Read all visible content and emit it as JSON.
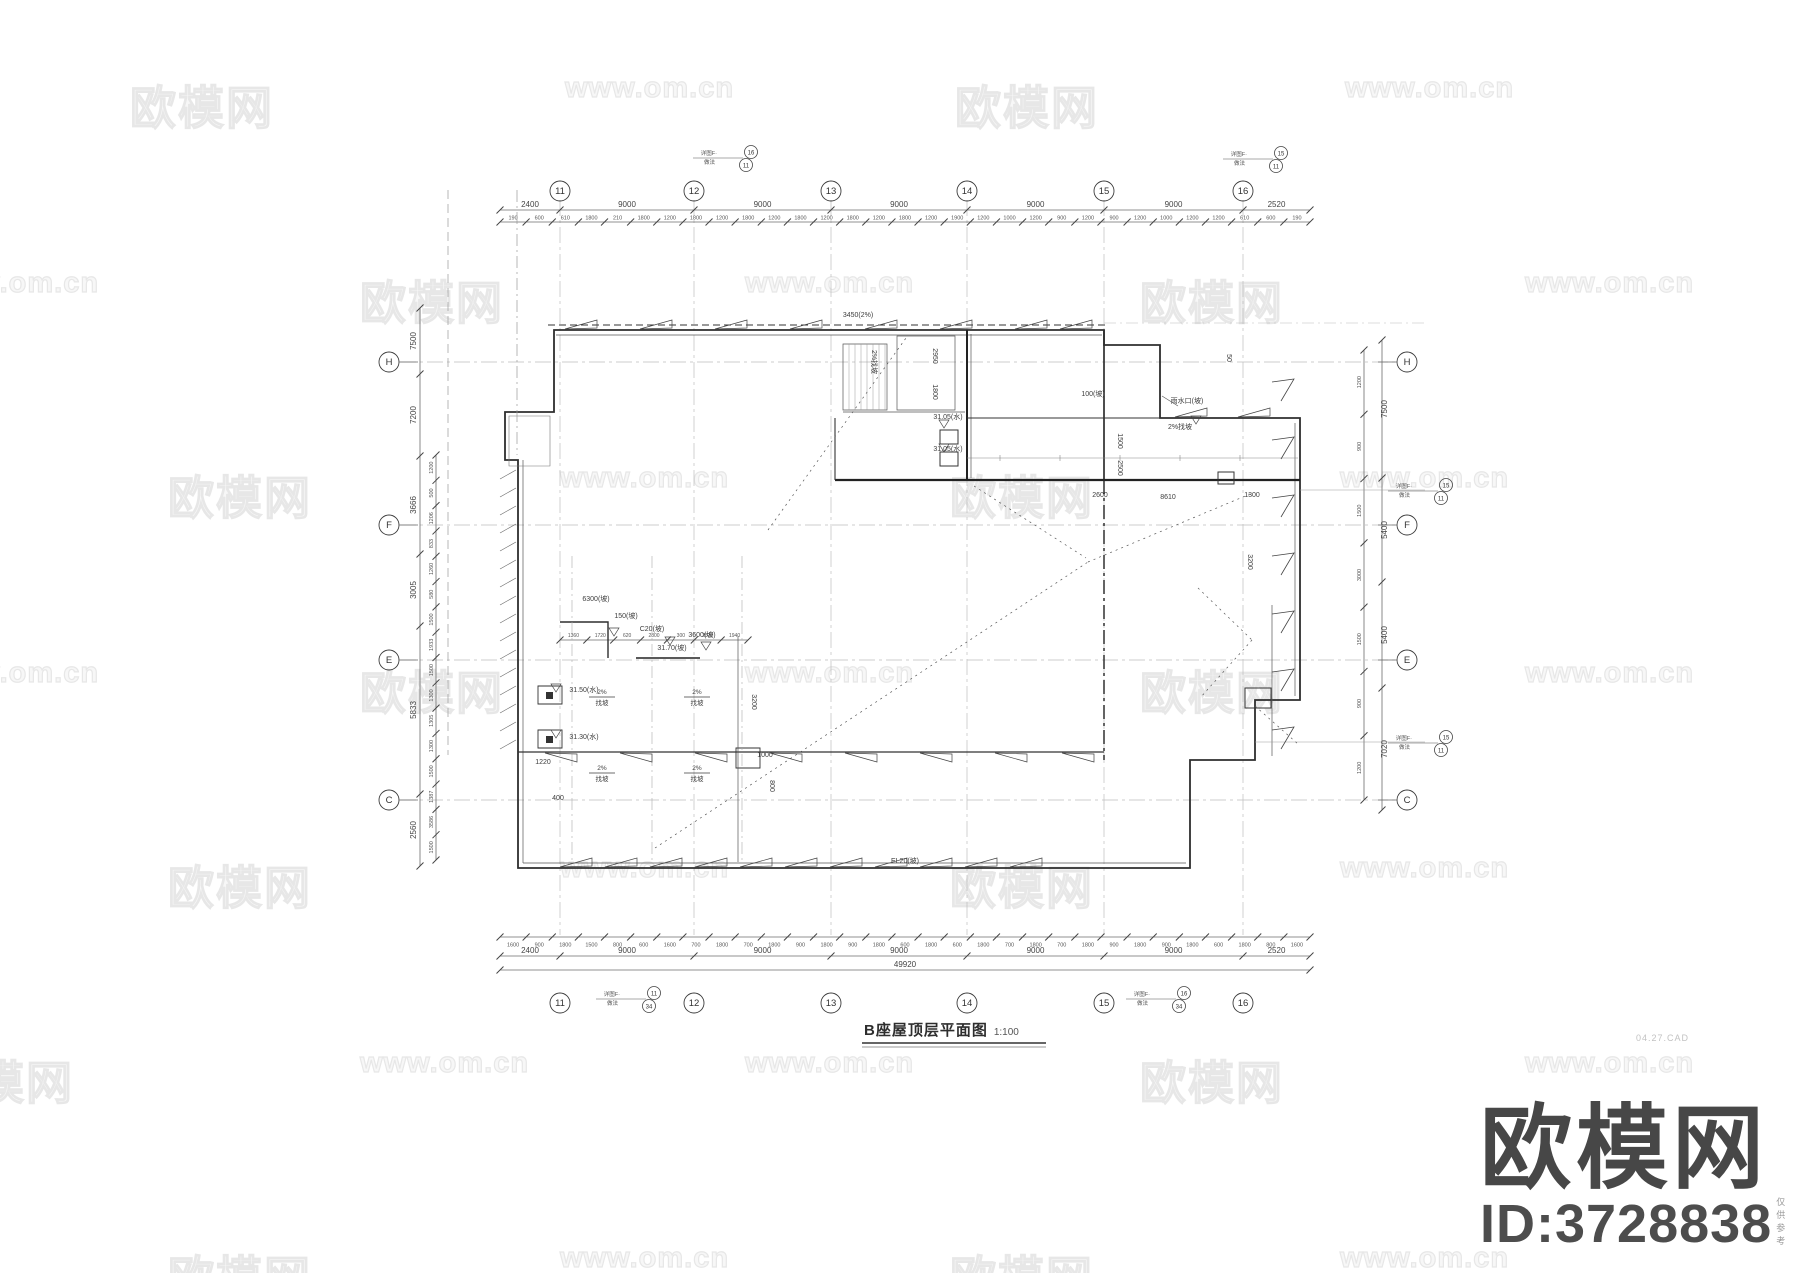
{
  "sheet": {
    "title": "B座屋顶层平面图",
    "scale": "1:100"
  },
  "brand": {
    "logo_text": "欧模网",
    "id_text": "ID:3728838",
    "note": "仅供参考",
    "date_note": "04.27.CAD"
  },
  "watermarks": {
    "cn_text": "欧模网",
    "en_text": "www.om.cn",
    "rows": [
      {
        "y": 72,
        "items": [
          {
            "x": 130,
            "k": "cn"
          },
          {
            "x": 565,
            "k": "en"
          },
          {
            "x": 955,
            "k": "cn"
          },
          {
            "x": 1345,
            "k": "en"
          }
        ]
      },
      {
        "y": 267,
        "items": [
          {
            "x": -70,
            "k": "en"
          },
          {
            "x": 360,
            "k": "cn"
          },
          {
            "x": 745,
            "k": "en"
          },
          {
            "x": 1140,
            "k": "cn"
          },
          {
            "x": 1525,
            "k": "en"
          }
        ]
      },
      {
        "y": 462,
        "items": [
          {
            "x": 168,
            "k": "cn"
          },
          {
            "x": 560,
            "k": "en"
          },
          {
            "x": 950,
            "k": "cn"
          },
          {
            "x": 1340,
            "k": "en"
          }
        ]
      },
      {
        "y": 657,
        "items": [
          {
            "x": -70,
            "k": "en"
          },
          {
            "x": 360,
            "k": "cn"
          },
          {
            "x": 745,
            "k": "en"
          },
          {
            "x": 1140,
            "k": "cn"
          },
          {
            "x": 1525,
            "k": "en"
          }
        ]
      },
      {
        "y": 852,
        "items": [
          {
            "x": 168,
            "k": "cn"
          },
          {
            "x": 560,
            "k": "en"
          },
          {
            "x": 950,
            "k": "cn"
          },
          {
            "x": 1340,
            "k": "en"
          }
        ]
      },
      {
        "y": 1047,
        "items": [
          {
            "x": -70,
            "k": "cn"
          },
          {
            "x": 360,
            "k": "en"
          },
          {
            "x": 745,
            "k": "en"
          },
          {
            "x": 1140,
            "k": "cn"
          },
          {
            "x": 1525,
            "k": "en"
          }
        ]
      },
      {
        "y": 1242,
        "items": [
          {
            "x": 168,
            "k": "cn"
          },
          {
            "x": 560,
            "k": "en"
          },
          {
            "x": 950,
            "k": "cn"
          },
          {
            "x": 1340,
            "k": "en"
          }
        ]
      }
    ]
  },
  "axes": {
    "top_numbers": [
      "11",
      "12",
      "13",
      "14",
      "15",
      "16"
    ],
    "bottom_numbers": [
      "11",
      "12",
      "13",
      "14",
      "15",
      "16"
    ],
    "left_letters": [
      "H",
      "F",
      "E",
      "C"
    ],
    "right_letters": [
      "H",
      "F",
      "E",
      "C"
    ]
  },
  "dimensions": {
    "top_major": [
      "2400",
      "9000",
      "9000",
      "9000",
      "9000",
      "9000",
      "2520"
    ],
    "bottom_major": [
      "2400",
      "9000",
      "9000",
      "9000",
      "9000",
      "9000",
      "2520"
    ],
    "overall": "49920",
    "top_minor": [
      "190",
      "600",
      "610",
      "1800",
      "210",
      "1800",
      "1200",
      "1800",
      "1200",
      "1800",
      "1200",
      "1800",
      "1200",
      "1800",
      "1200",
      "1800",
      "1200",
      "1900",
      "1200",
      "1000",
      "1200",
      "900",
      "1200",
      "900",
      "1200",
      "1000",
      "1200",
      "1200",
      "610",
      "600",
      "190"
    ],
    "bottom_minor": [
      "1600",
      "900",
      "1800",
      "1500",
      "800",
      "600",
      "1600",
      "700",
      "1800",
      "700",
      "1800",
      "900",
      "1800",
      "900",
      "1800",
      "600",
      "1800",
      "600",
      "1800",
      "700",
      "1800",
      "700",
      "1800",
      "900",
      "1800",
      "900",
      "1800",
      "600",
      "1800",
      "800",
      "1600"
    ],
    "left_major": [
      "7500",
      "7200",
      "3666",
      "3005",
      "5833",
      "2560"
    ],
    "left_minor": [
      "1200",
      "500",
      "1206",
      "833",
      "1260",
      "580",
      "1500",
      "1933",
      "1500",
      "1300",
      "1305",
      "1300",
      "1500",
      "1387",
      "3586",
      "1500"
    ],
    "right_major": [
      "7500",
      "5400",
      "5400",
      "7020"
    ],
    "right_minor": [
      "1200",
      "900",
      "1500",
      "3000",
      "1500",
      "900",
      "1200"
    ],
    "platform_chain": [
      "1360",
      "1720",
      "620",
      "2800",
      "300",
      "2820",
      "1940"
    ]
  },
  "annotations": [
    {
      "x": 858,
      "y": 317,
      "t": "3450(2%)"
    },
    {
      "x": 905,
      "y": 863,
      "t": "EL20(坡)"
    },
    {
      "x": 1187,
      "y": 403,
      "t": "雨水口(坡)"
    },
    {
      "x": 1093,
      "y": 396,
      "t": "100(坡)"
    },
    {
      "x": 1180,
      "y": 429,
      "t": "2%找坡"
    },
    {
      "x": 948,
      "y": 419,
      "t": "31.05(水)"
    },
    {
      "x": 948,
      "y": 451,
      "t": "31.05(水)"
    },
    {
      "x": 584,
      "y": 692,
      "t": "31.50(水)"
    },
    {
      "x": 584,
      "y": 739,
      "t": "31.30(水)"
    },
    {
      "x": 596,
      "y": 601,
      "t": "6300(坡)"
    },
    {
      "x": 626,
      "y": 618,
      "t": "150(坡)"
    },
    {
      "x": 652,
      "y": 631,
      "t": "C20(坡)"
    },
    {
      "x": 702,
      "y": 637,
      "t": "3600(坡)"
    },
    {
      "x": 672,
      "y": 650,
      "t": "31.70(坡)"
    },
    {
      "x": 543,
      "y": 764,
      "t": "1220"
    },
    {
      "x": 558,
      "y": 800,
      "t": "400"
    },
    {
      "x": 765,
      "y": 757,
      "t": "1000"
    },
    {
      "x": 1168,
      "y": 499,
      "t": "8610"
    },
    {
      "x": 1100,
      "y": 497,
      "t": "2600"
    },
    {
      "x": 1252,
      "y": 497,
      "t": "1300"
    },
    {
      "x": 933,
      "y": 356,
      "t": "2950",
      "rot": 90
    },
    {
      "x": 933,
      "y": 392,
      "t": "1800",
      "rot": 90
    },
    {
      "x": 1118,
      "y": 441,
      "t": "1500",
      "rot": 90
    },
    {
      "x": 1118,
      "y": 468,
      "t": "2500",
      "rot": 90
    },
    {
      "x": 1227,
      "y": 358,
      "t": "50",
      "rot": 90
    },
    {
      "x": 1248,
      "y": 562,
      "t": "3200",
      "rot": 90
    },
    {
      "x": 770,
      "y": 786,
      "t": "800",
      "rot": 90
    },
    {
      "x": 752,
      "y": 702,
      "t": "3200",
      "rot": 90
    },
    {
      "x": 872,
      "y": 362,
      "t": "2%找坡",
      "rot": 90
    }
  ],
  "slope_labels": {
    "top": "2%",
    "bottom": "找坡",
    "positions": [
      {
        "x": 602,
        "y": 696
      },
      {
        "x": 697,
        "y": 696
      },
      {
        "x": 602,
        "y": 772
      },
      {
        "x": 697,
        "y": 772
      }
    ]
  },
  "callouts": [
    {
      "x": 745,
      "y": 157,
      "l1": "详图F·",
      "l2": "做法",
      "top": "16",
      "bot": "11"
    },
    {
      "x": 1275,
      "y": 158,
      "l1": "详图F·",
      "l2": "做法",
      "top": "15",
      "bot": "11"
    },
    {
      "x": 1440,
      "y": 490,
      "l1": "详图F·",
      "l2": "做法",
      "top": "15",
      "bot": "11"
    },
    {
      "x": 1440,
      "y": 742,
      "l1": "详图F·",
      "l2": "做法",
      "top": "15",
      "bot": "11"
    },
    {
      "x": 648,
      "y": 998,
      "l1": "详图F·",
      "l2": "做法",
      "top": "11",
      "bot": "34"
    },
    {
      "x": 1178,
      "y": 998,
      "l1": "详图F·",
      "l2": "做法",
      "top": "16",
      "bot": "34"
    }
  ],
  "colors": {
    "line_dark": "#2e2e2e",
    "line_mid": "#555555",
    "dim": "#6b6b6b",
    "grid": "#bdbdbd",
    "watermark": "#ededed",
    "logo": "#474747"
  }
}
